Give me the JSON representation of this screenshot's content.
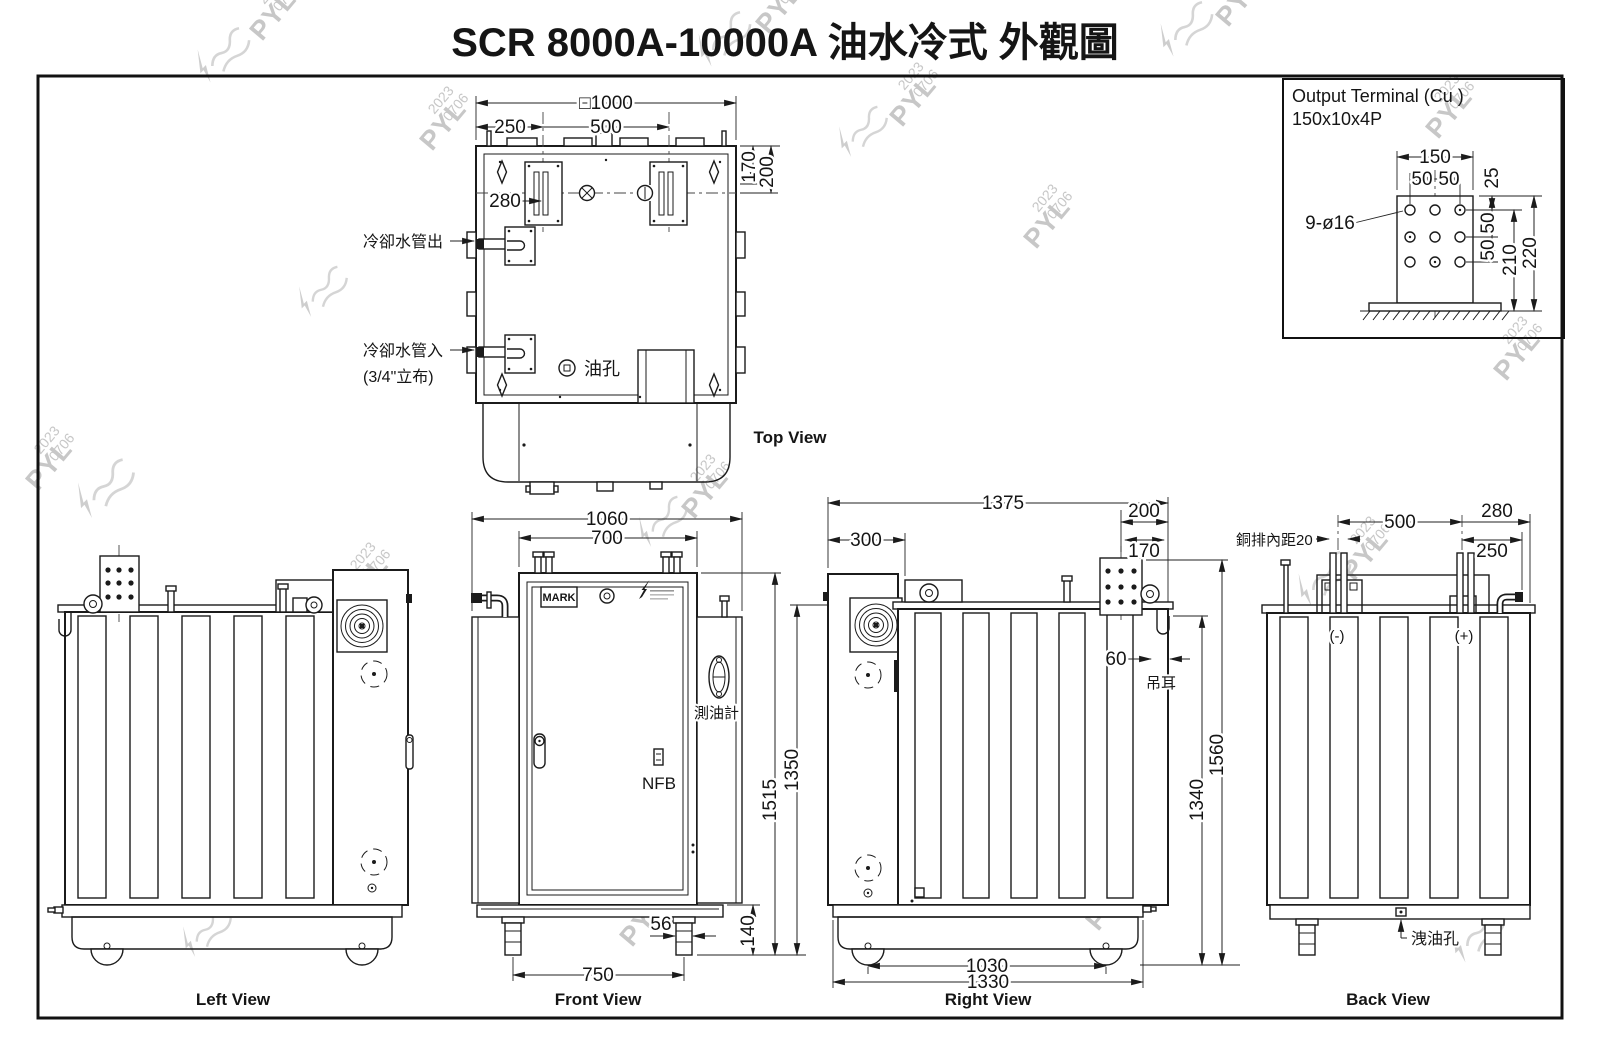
{
  "title": "SCR 8000A-10000A 油水冷式 外觀圖",
  "watermark": {
    "name": "PYL",
    "year": "2023",
    "date": "0706"
  },
  "output_terminal": {
    "title_line1": "Output Terminal (Cu )",
    "title_line2": "150x10x4P",
    "holes_note": "9-ø16",
    "dim_150": "150",
    "dim_50a": "50",
    "dim_50b": "50",
    "dim_25": "25",
    "dim_50c": "50",
    "dim_50d": "50",
    "dim_210": "210",
    "dim_220": "220"
  },
  "top_view": {
    "label": "Top View",
    "dim_overall": "□1000",
    "dim_250": "250",
    "dim_500": "500",
    "dim_170": "170",
    "dim_200": "200",
    "dim_280": "280",
    "note_water_out": "冷卻水管出",
    "note_water_in": "冷卻水管入",
    "note_water_in_size": "(3/4\"立布)",
    "note_oil_hole": "油孔"
  },
  "front_view": {
    "label": "Front View",
    "dim_1060": "1060",
    "dim_700": "700",
    "dim_1515": "1515",
    "dim_1350": "1350",
    "dim_56": "56",
    "dim_140": "140",
    "dim_750": "750",
    "note_mark": "MARK",
    "note_nfb": "NFB",
    "note_oil_gauge": "測油計"
  },
  "left_view": {
    "label": "Left View"
  },
  "right_view": {
    "label": "Right View",
    "dim_1375": "1375",
    "dim_300": "300",
    "dim_200": "200",
    "dim_170": "170",
    "dim_60": "60",
    "dim_1340": "1340",
    "dim_1560": "1560",
    "dim_1030": "1030",
    "dim_1330": "1330",
    "note_lug": "吊耳"
  },
  "back_view": {
    "label": "Back View",
    "dim_500": "500",
    "dim_280": "280",
    "dim_250": "250",
    "note_busbar_gap": "銅排內距20",
    "note_minus": "(-)",
    "note_plus": "(+)",
    "note_drain": "洩油孔"
  }
}
